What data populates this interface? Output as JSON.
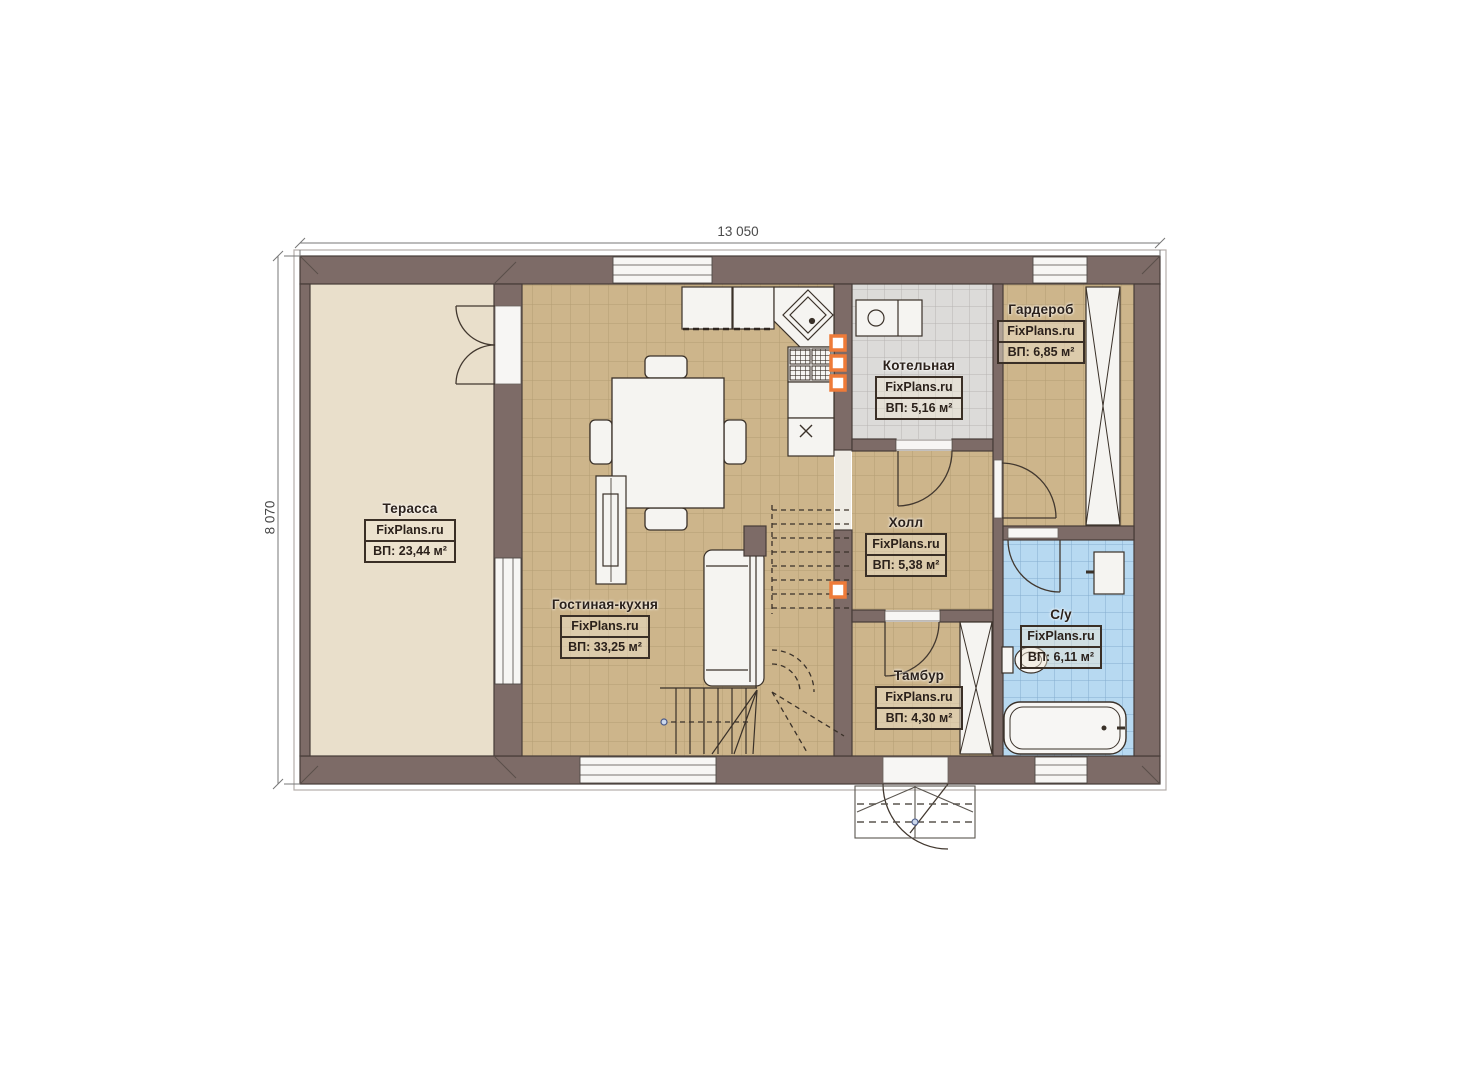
{
  "plan": {
    "watermark": "FixPlans.ru",
    "dimensions": {
      "width": "13 050",
      "height": "8 070"
    },
    "rooms": [
      {
        "name": "Терасса",
        "area": "ВП: 23,44 м²"
      },
      {
        "name": "Гостиная-кухня",
        "area": "ВП: 33,25 м²"
      },
      {
        "name": "Котельная",
        "area": "ВП: 5,16 м²"
      },
      {
        "name": "Гардероб",
        "area": "ВП: 6,85 м²"
      },
      {
        "name": "Холл",
        "area": "ВП: 5,38 м²"
      },
      {
        "name": "Тамбур",
        "area": "ВП: 4,30 м²"
      },
      {
        "name": "С/у",
        "area": "ВП: 6,11 м²"
      }
    ],
    "colors": {
      "wall": "#7d6b67",
      "terrace_floor": "#e9dfcb",
      "tile_tan": "#cdb58b",
      "tile_gray": "#dcdbd9",
      "tile_blue": "#b7d9f1",
      "accent_orange": "#ee7b39"
    }
  }
}
